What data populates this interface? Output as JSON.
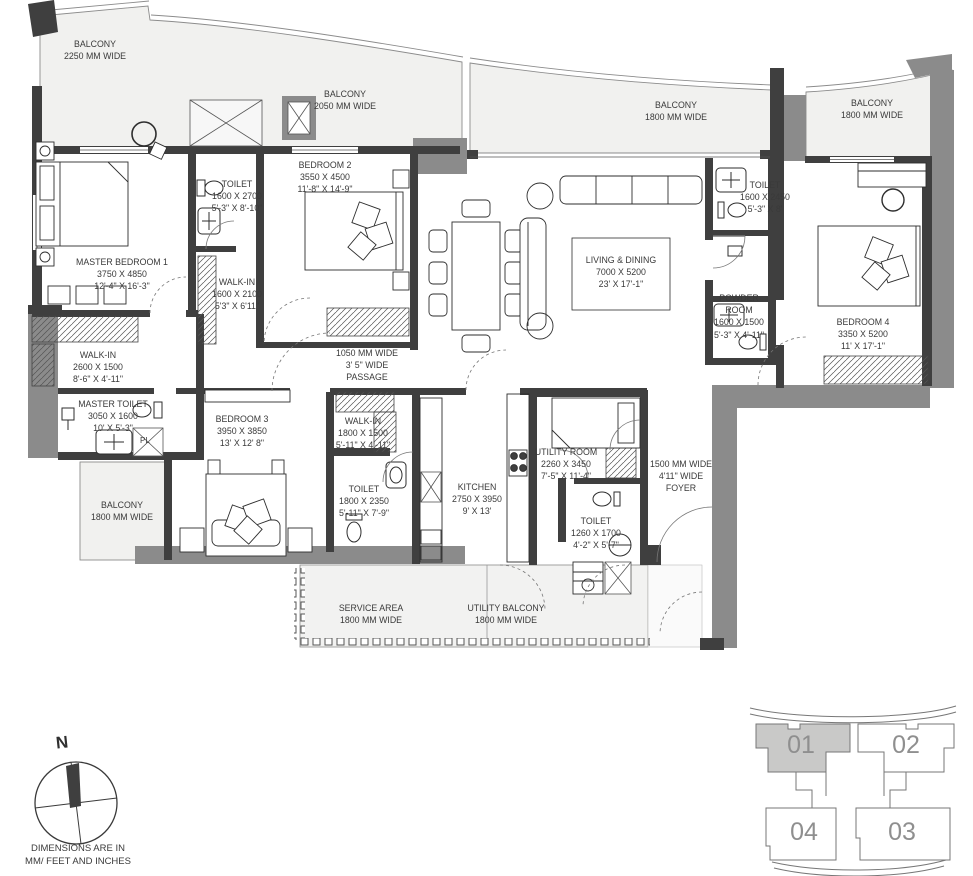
{
  "colors": {
    "wall_dark": "#3f3f3f",
    "wall_gray": "#8b8b8b",
    "balcony_fill": "#f1f1ef",
    "keyplan_selected_fill": "#c9c9c8",
    "text": "#3a3a3a"
  },
  "rooms": {
    "bal_master": {
      "name": "BALCONY",
      "dim": "2250 MM WIDE"
    },
    "bal_b2": {
      "name": "BALCONY",
      "dim": "2050 MM WIDE"
    },
    "bal_liv": {
      "name": "BALCONY",
      "dim": "1800 MM WIDE"
    },
    "bal_b4": {
      "name": "BALCONY",
      "dim": "1800 MM WIDE"
    },
    "mbr": {
      "name": "MASTER BEDROOM 1",
      "mm": "3750 X 4850",
      "ft": "12'-4\" X 16'-3\""
    },
    "toilet_m": {
      "name": "TOILET",
      "mm": "1600 X 2700",
      "ft": "5'-3\" X 8'-10\""
    },
    "walkin_m": {
      "name": "WALK-IN",
      "mm": "1600 X 2100",
      "ft": "5'3\" X 6'11\""
    },
    "b2": {
      "name": "BEDROOM 2",
      "mm": "3550 X 4500",
      "ft": "11'-8\" X 14'-9\""
    },
    "living": {
      "name": "LIVING & DINING",
      "mm": "7000 X 5200",
      "ft": "23' X 17'-1\""
    },
    "toilet_b4": {
      "name": "TOILET",
      "mm": "1600 X 2450",
      "ft": "5'-3\" X 8'"
    },
    "powder": {
      "l1": "POWDER",
      "l2": "ROOM",
      "mm": "1600 X 1500",
      "ft": "5'-3\" X 4'-11\""
    },
    "b4": {
      "name": "BEDROOM 4",
      "mm": "3350 X 5200",
      "ft": "11' X 17'-1\""
    },
    "walkin2": {
      "name": "WALK-IN",
      "mm": "2600 X 1500",
      "ft": "8'-6\" X 4'-11\""
    },
    "mtoilet": {
      "name": "MASTER TOILET",
      "mm": "3050 X 1600",
      "ft": "10' X 5'-3\""
    },
    "pl": {
      "label": "PL"
    },
    "bal_b3": {
      "name": "BALCONY",
      "dim": "1800 MM WIDE"
    },
    "b3": {
      "name": "BEDROOM 3",
      "mm": "3950 X 3850",
      "ft": "13' X 12' 8\""
    },
    "passage": {
      "l1": "1050 MM WIDE",
      "l2": "3' 5\" WIDE",
      "l3": "PASSAGE"
    },
    "walkin3": {
      "name": "WALK-IN",
      "mm": "1800 X 1500",
      "ft": "5'-11\" X 4'-11\""
    },
    "toilet3": {
      "name": "TOILET",
      "mm": "1800 X 2350",
      "ft": "5'-11\" X 7'-9\""
    },
    "kitchen": {
      "name": "KITCHEN",
      "mm": "2750 X 3950",
      "ft": "9' X 13'"
    },
    "utility": {
      "name": "UTILITY ROOM",
      "mm": "2260 X 3450",
      "ft": "7'-5\" X 11'-4\""
    },
    "toilet_u": {
      "name": "TOILET",
      "mm": "1260 X 1700",
      "ft": "4'-2\" X 5'-7\""
    },
    "foyer": {
      "l1": "1500 MM WIDE",
      "l2": "4'11\" WIDE",
      "l3": "FOYER"
    },
    "service": {
      "name": "SERVICE AREA",
      "dim": "1800 MM WIDE"
    },
    "ubalcony": {
      "name": "UTILITY BALCONY",
      "dim": "1800 MM WIDE"
    }
  },
  "compass": {
    "north": "N"
  },
  "note": {
    "l1": "DIMENSIONS ARE IN",
    "l2": "MM/ FEET AND INCHES"
  },
  "keyplan": {
    "unit1": "01",
    "unit2": "02",
    "unit3": "03",
    "unit4": "04"
  }
}
